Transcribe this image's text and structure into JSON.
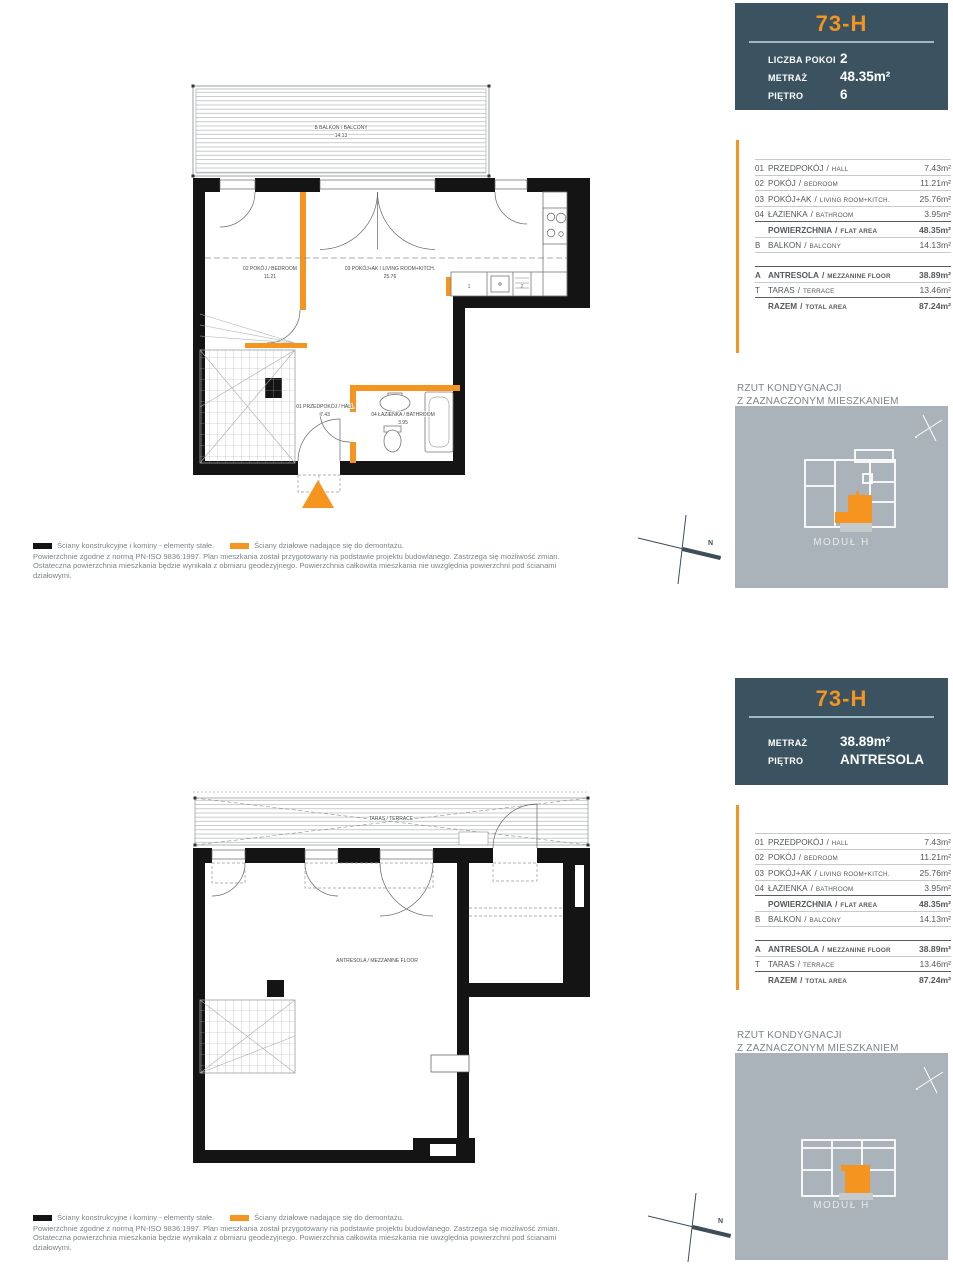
{
  "colors": {
    "panel_bg": "#3b5361",
    "accent_orange": "#f5941e",
    "minimap_bg": "#a9b3b9",
    "wall_black": "#141414"
  },
  "top_section": {
    "header": {
      "title": "73-H",
      "rows": [
        {
          "label": "LICZBA POKOI",
          "value": "2"
        },
        {
          "label": "METRAŻ",
          "value": "48.35m²"
        },
        {
          "label": "PIĘTRO",
          "value": "6"
        }
      ]
    },
    "floor_note": {
      "line1": "RZUT KONDYGNACJI",
      "line2": "Z ZAZNACZONYM MIESZKANIEM"
    },
    "minimap_module": "MODUŁ H",
    "compass": "N",
    "plan_labels": {
      "balcony": "B BALKON / BALCONY",
      "balcony_area": "14.13",
      "bedroom": "02 POKÓJ / BEDROOM",
      "bedroom_area": "11.21",
      "living": "03 POKÓJ+AK / LIVING ROOM+KITCH.",
      "living_area": "25.76",
      "hall": "01 PRZEDPOKÓJ / HALL",
      "hall_area": "7.43",
      "bathroom": "04 ŁAZIENKA / BATHROOM",
      "bathroom_area": "3.95",
      "kitchen_item_1": "1",
      "kitchen_item_2": "2"
    }
  },
  "bottom_section": {
    "header": {
      "title": "73-H",
      "rows": [
        {
          "label": "METRAŻ",
          "value": "38.89m²"
        },
        {
          "label": "PIĘTRO",
          "value": "ANTRESOLA"
        }
      ]
    },
    "floor_note": {
      "line1": "RZUT KONDYGNACJI",
      "line2": "Z ZAZNACZONYM MIESZKANIEM"
    },
    "minimap_module": "MODUŁ H",
    "compass": "N",
    "plan_labels": {
      "terrace": "TARAS / TERRACE",
      "mezzanine": "ANTRESOLA / MEZZANINE FLOOR"
    }
  },
  "area_table": {
    "sep": "/",
    "rows": [
      {
        "code": "01",
        "pl": "PRZEDPOKÓJ",
        "en": "HALL",
        "value": "7.43m²"
      },
      {
        "code": "02",
        "pl": "POKÓJ",
        "en": "BEDROOM",
        "value": "11.21m²"
      },
      {
        "code": "03",
        "pl": "POKÓJ+AK",
        "en": "LIVING ROOM+KITCH.",
        "value": "25.76m²"
      },
      {
        "code": "04",
        "pl": "ŁAZIENKA",
        "en": "BATHROOM",
        "value": "3.95m²"
      },
      {
        "code": "",
        "pl": "POWIERZCHNIA",
        "en": "FLAT AREA",
        "value": "48.35m²"
      },
      {
        "code": "B",
        "pl": "BALKON",
        "en": "BALCONY",
        "value": "14.13m²"
      },
      {
        "code": "A",
        "pl": "ANTRESOLA",
        "en": "MEZZANINE FLOOR",
        "value": "38.89m²"
      },
      {
        "code": "T",
        "pl": "TARAS",
        "en": "TERRACE",
        "value": "13.46m²"
      },
      {
        "code": "",
        "pl": "RAZEM",
        "en": "TOTAL AREA",
        "value": "87.24m²"
      }
    ]
  },
  "legend": {
    "structural": "Ściany konstrukcyjne i kominy - elementy stałe.",
    "partition": "Ściany działowe nadające się do demontażu.",
    "note1": "Powierzchnie zgodne z normą PN-ISO 9836:1997. Plan mieszkania został przygotowany na podstawie projektu budowlanego. Zastrzega się możliwość zmian.",
    "note2": "Ostateczna powierzchnia mieszkania będzie wynikała z obmiaru geodezyjnego. Powierzchnia całkowita mieszkania nie uwzględnia powierzchni pod ścianami działowymi."
  }
}
